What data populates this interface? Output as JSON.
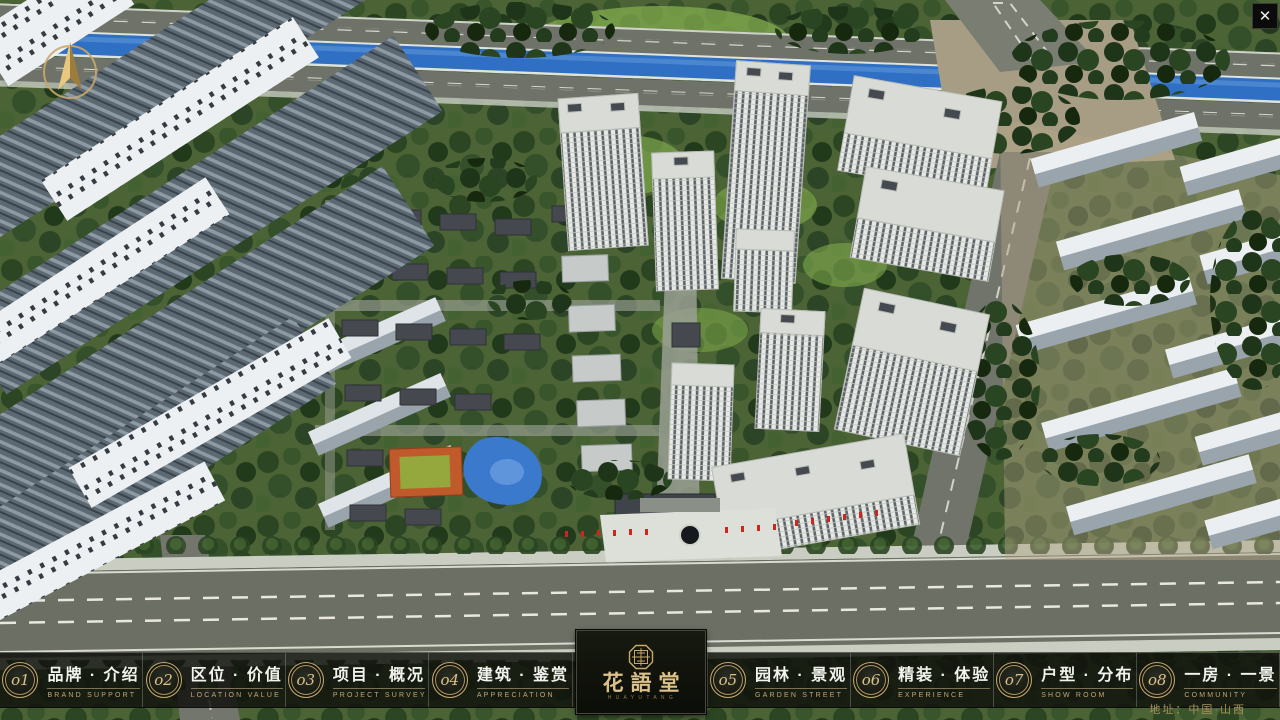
{
  "palette": {
    "gold": "#c7a86a",
    "nav_bg": "rgba(16,18,13,0.85)",
    "river_blue": "#2f6fc4",
    "grass_green": "#4c6336",
    "flag_red": "#c8281e"
  },
  "chrome": {
    "close_label": "✕"
  },
  "nav": {
    "items": [
      {
        "num": "o1",
        "zh": "品牌 · 介绍",
        "en": "BRAND SUPPORT"
      },
      {
        "num": "o2",
        "zh": "区位 · 价值",
        "en": "LOCATION VALUE"
      },
      {
        "num": "o3",
        "zh": "项目 · 概况",
        "en": "PROJECT SURVEY"
      },
      {
        "num": "o4",
        "zh": "建筑 · 鉴赏",
        "en": "APPRECIATION"
      },
      {
        "num": "o5",
        "zh": "园林 · 景观",
        "en": "GARDEN STREET"
      },
      {
        "num": "o6",
        "zh": "精装 · 体验",
        "en": "EXPERIENCE"
      },
      {
        "num": "o7",
        "zh": "户型 · 分布",
        "en": "SHOW ROOM"
      },
      {
        "num": "o8",
        "zh": "一房 · 一景",
        "en": "COMMUNITY"
      }
    ],
    "logo": {
      "zh": "花語堂",
      "sub": "H U A Y U T A N G"
    }
  },
  "footer": {
    "address": "地址：中国·山西"
  }
}
